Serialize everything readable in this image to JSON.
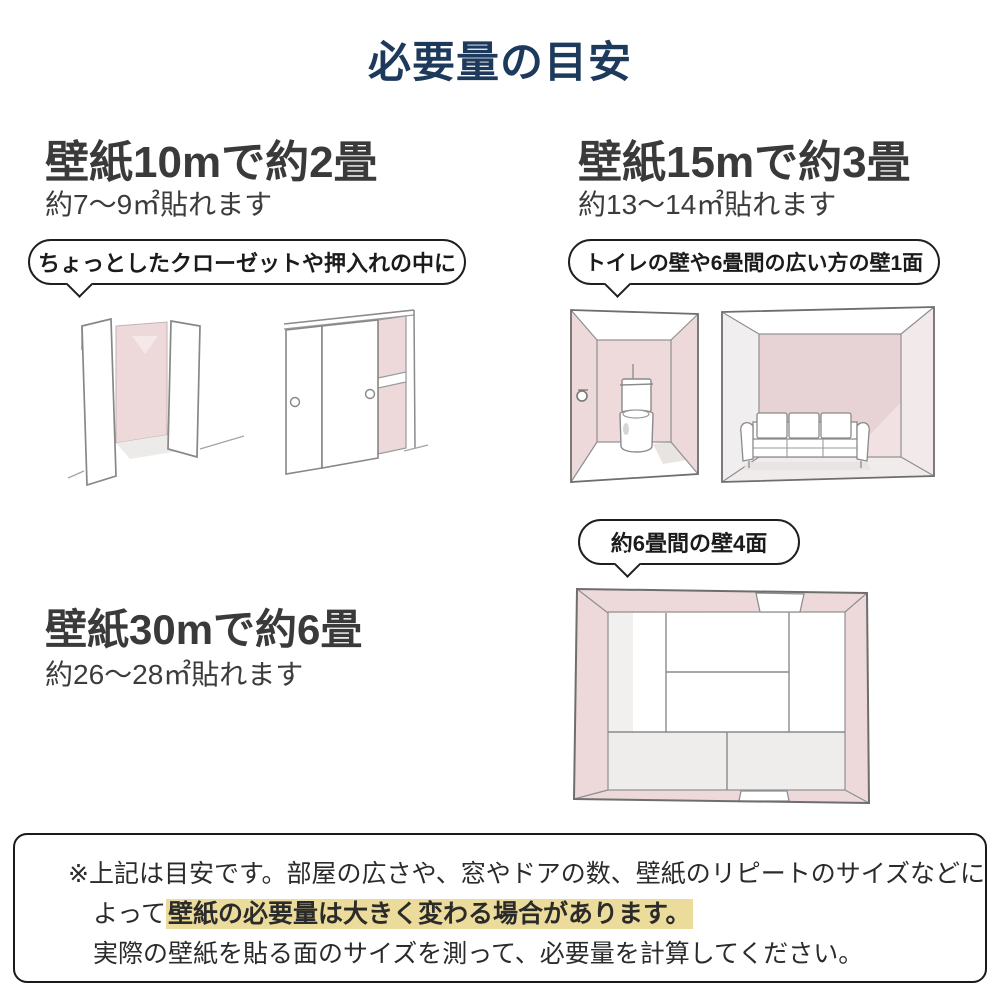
{
  "title": "必要量の目安",
  "sections": [
    {
      "heading": "壁紙10mで約2畳",
      "subtext": "約7〜9㎡貼れます",
      "bubble": "ちょっとしたクローゼットや押入れの中に"
    },
    {
      "heading": "壁紙15mで約3畳",
      "subtext": "約13〜14㎡貼れます",
      "bubble": "トイレの壁や6畳間の広い方の壁1面"
    },
    {
      "heading": "壁紙30mで約6畳",
      "subtext": "約26〜28㎡貼れます",
      "bubble": "約6畳間の壁4面"
    }
  ],
  "illustrations": [
    {
      "name": "closet-open-doors-illustration"
    },
    {
      "name": "sliding-door-closet-illustration"
    },
    {
      "name": "toilet-room-illustration"
    },
    {
      "name": "sofa-room-wall-illustration"
    },
    {
      "name": "six-mat-room-top-view-illustration"
    }
  ],
  "footer": {
    "line1": "※上記は目安です。部屋の広さや、窓やドアの数、壁紙のリピートのサイズなどに",
    "line2_prefix": "よって",
    "line2_highlight": "壁紙の必要量は大きく変わる場合があります。",
    "line3": "実際の壁紙を貼る面のサイズを測って、必要量を計算してください。"
  },
  "colors": {
    "title_navy": "#1d3a5c",
    "text_dark": "#3a3a3a",
    "wall_pink": "#edd9da",
    "wall_pink_deep": "#e7d2d5",
    "highlight_yellow": "#ecdc9b"
  }
}
